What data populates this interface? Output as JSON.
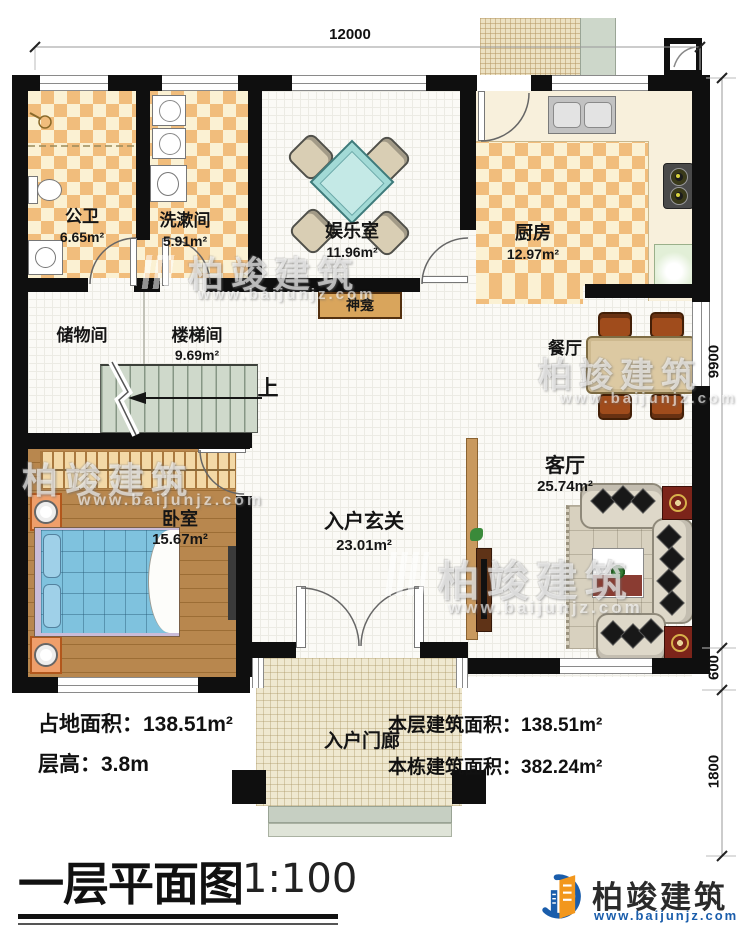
{
  "dims": {
    "top": "12000",
    "right_main": "9900",
    "right_mid": "600",
    "right_bottom": "1800"
  },
  "rooms": {
    "bath": {
      "name": "公卫",
      "area": "6.65m²"
    },
    "wash": {
      "name": "洗漱间",
      "area": "5.91m²"
    },
    "game": {
      "name": "娱乐室",
      "area": "11.96m²"
    },
    "kitchen": {
      "name": "厨房",
      "area": "12.97m²"
    },
    "storage": {
      "name": "储物间"
    },
    "stair": {
      "name": "楼梯间",
      "area": "9.69m²"
    },
    "dining": {
      "name": "餐厅"
    },
    "living": {
      "name": "客厅",
      "area": "25.74m²"
    },
    "bedroom": {
      "name": "卧室",
      "area": "15.67m²"
    },
    "foyer": {
      "name": "入户玄关",
      "area": "23.01m²"
    },
    "porch": {
      "name": "入户门廊"
    },
    "shrine": {
      "name": "神龛"
    }
  },
  "labels": {
    "up": "上"
  },
  "stats": {
    "land": {
      "label": "占地面积：",
      "value": "138.51m²"
    },
    "height": {
      "label": "层高：",
      "value": "3.8m"
    },
    "floor": {
      "label": "本层建筑面积：",
      "value": "138.51m²"
    },
    "building": {
      "label": "本栋建筑面积：",
      "value": "382.24m²"
    }
  },
  "title": {
    "text": "一层平面图",
    "scale": "1:100"
  },
  "brand": {
    "name": "柏竣建筑",
    "url": "www.baijunjz.com"
  },
  "colors": {
    "accent_blue": "#1a5dab",
    "accent_orange": "#f2971d",
    "wall": "#0f0f0f"
  }
}
